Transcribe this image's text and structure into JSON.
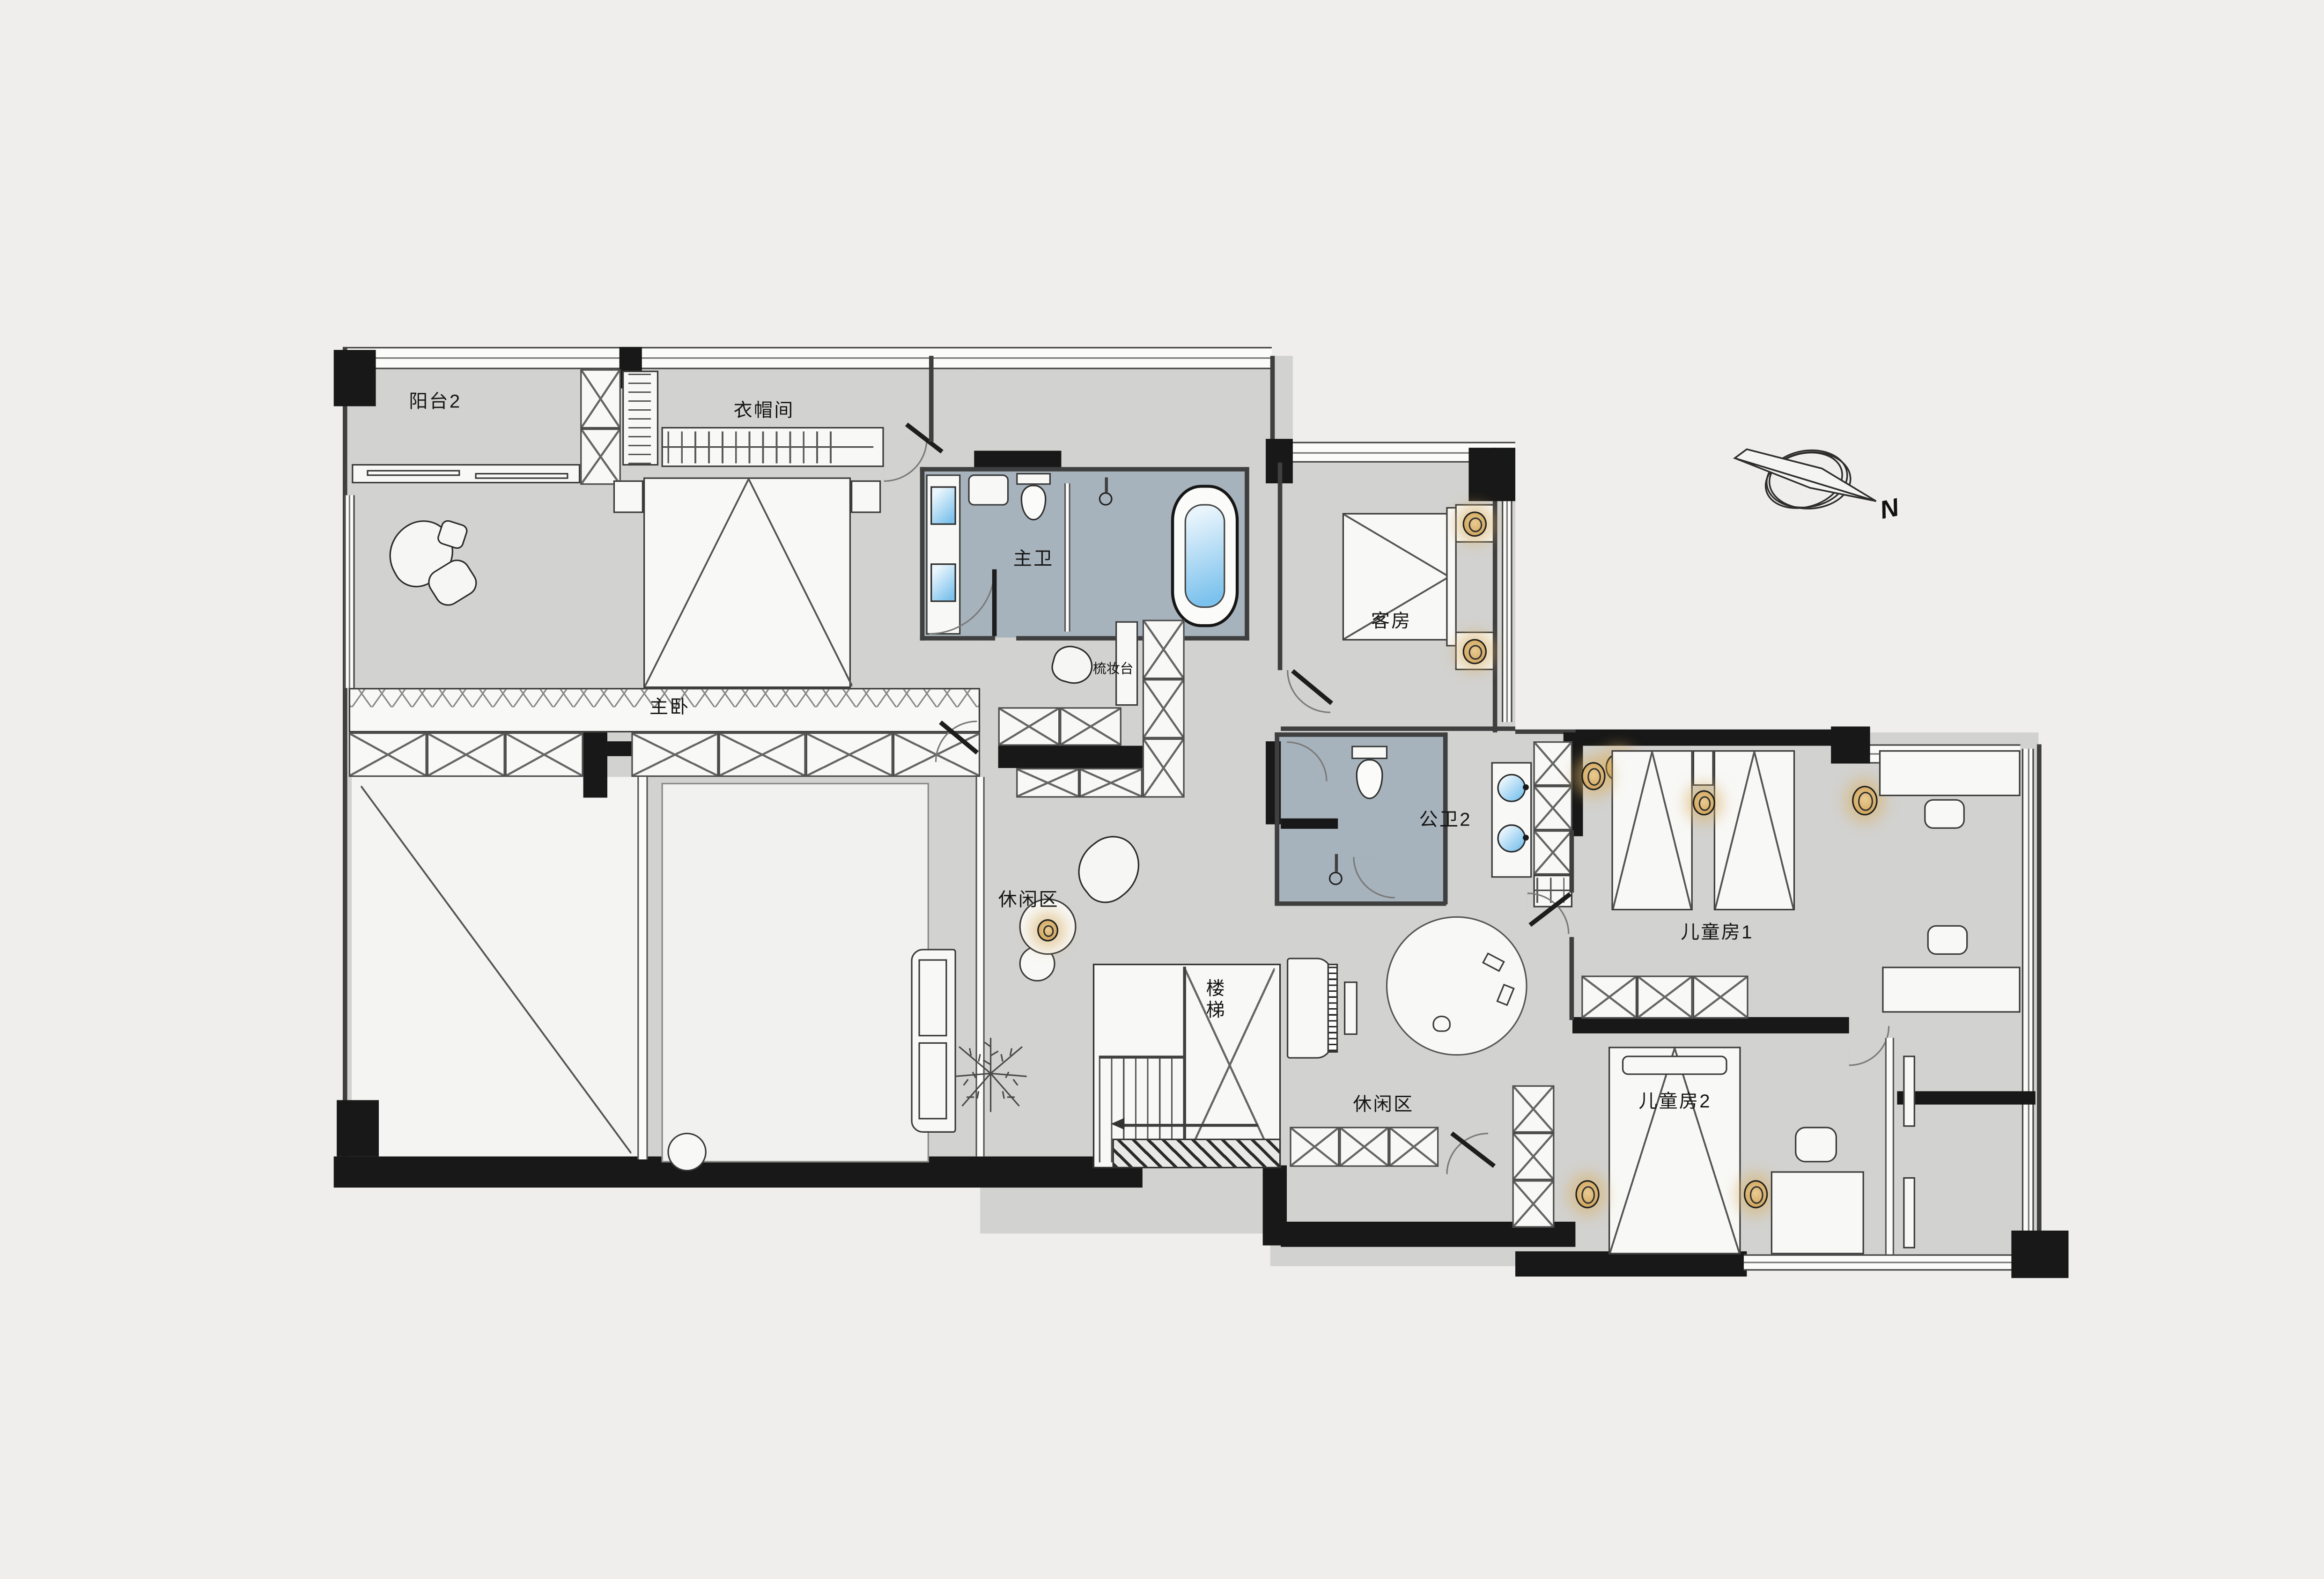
{
  "plan": {
    "labels": {
      "balcony2": "阳台2",
      "cloakroom": "衣帽间",
      "master_bedroom": "主卧",
      "master_bath": "主卫",
      "dressing_table": "梳妆台",
      "guest_room": "客房",
      "public_bath2": "公卫2",
      "kids_room1": "儿童房1",
      "kids_room2": "儿童房2",
      "leisure_west": "休闲区",
      "leisure_east": "休闲区",
      "stairs": "楼梯"
    },
    "compass": {
      "north_label": "N"
    },
    "colors": {
      "background": "#efeeec",
      "floor_gray": "#d2d2d0",
      "bath_floor_blue": "#a7b3bc",
      "wall_black": "#181818",
      "water_blue": "#7cc2ed",
      "wood_accent_gold": "#d3a45c"
    }
  }
}
